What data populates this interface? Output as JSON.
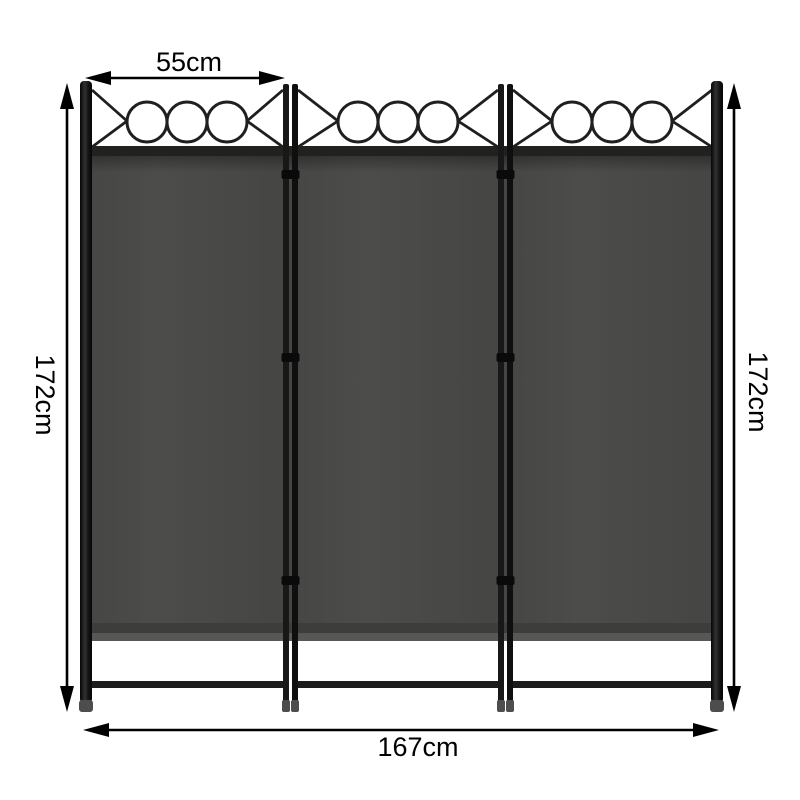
{
  "illustration": {
    "subject": "3-panel folding room divider screen",
    "panel_count": 3,
    "decor_circles_per_panel": 3,
    "dimension_labels": {
      "panel_width": "55cm",
      "height_left": "172cm",
      "height_right": "172cm",
      "total_width": "167cm"
    },
    "colors": {
      "background": "#ffffff",
      "fabric": "#4a4a48",
      "fabric_top_rail": "#21211f",
      "fabric_bottom_highlight": "#575755",
      "frame": "#141414",
      "foot_cap": "#4d4d4d",
      "dimension_lines": "#000000"
    }
  }
}
